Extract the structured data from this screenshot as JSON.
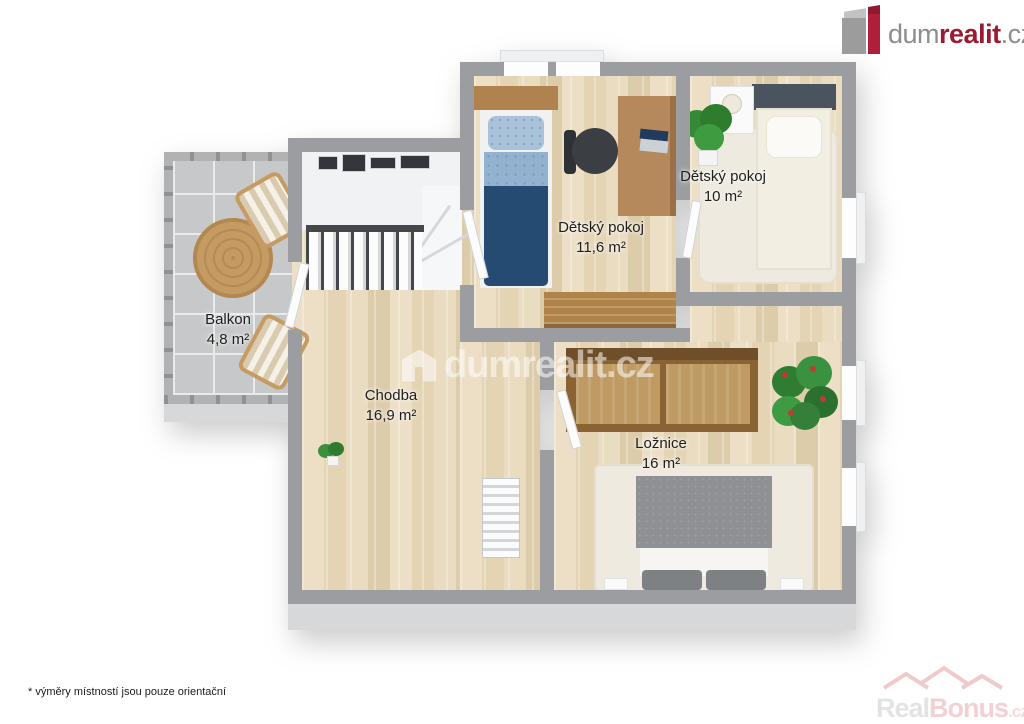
{
  "header": {
    "logo": {
      "part1": "dum",
      "part2": "realit",
      "part3": ".cz"
    }
  },
  "floorplan": {
    "rooms": [
      {
        "name": "Balkon",
        "area": "4,8 m²"
      },
      {
        "name": "Chodba",
        "area": "16,9 m²"
      },
      {
        "name": "Dětský pokoj",
        "area": "11,6 m²"
      },
      {
        "name": "Dětský pokoj",
        "area": "10 m²"
      },
      {
        "name": "Ložnice",
        "area": "16 m²"
      }
    ]
  },
  "watermarks": {
    "center": "dumrealit.cz",
    "corner": {
      "part1": "Real",
      "part2": "Bonus",
      "part3": ".cz"
    }
  },
  "footnote": "* výměry místností jsou pouze orientační",
  "colors": {
    "wall": "#9b9da0",
    "wood_floor": "#e8dabd",
    "balcony_tile": "#c7c8c9",
    "logo_red": "#9c1b33",
    "logo_gray": "#8d8d8d",
    "bed_navy": "#254b73",
    "bed_gray": "#8e9093"
  }
}
